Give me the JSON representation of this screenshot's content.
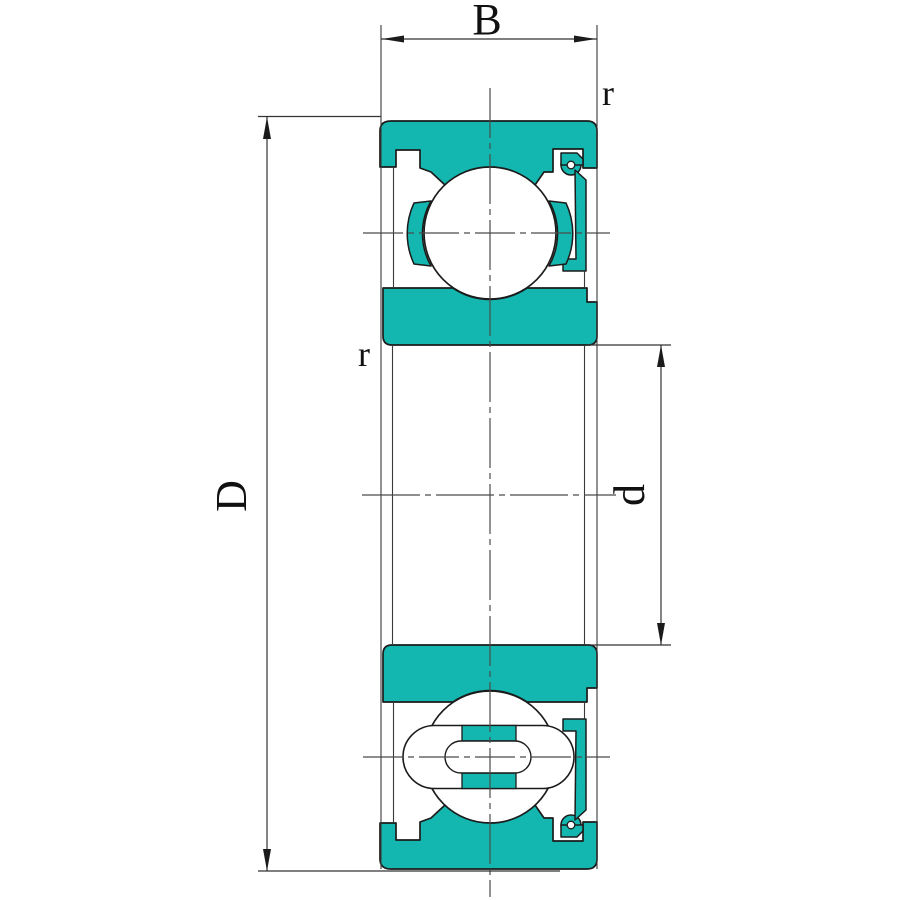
{
  "drawing": {
    "kind": "deep-groove-ball-bearing-cross-section",
    "labels": {
      "width": "B",
      "outer_diameter": "D",
      "bore_diameter": "d",
      "chamfer_outer": "r",
      "chamfer_inner": "r"
    },
    "colors": {
      "fill": "#14b7af",
      "outline": "#1b1b1b",
      "dim": "#333333",
      "center": "#4a4a4a",
      "background": "#ffffff"
    }
  }
}
